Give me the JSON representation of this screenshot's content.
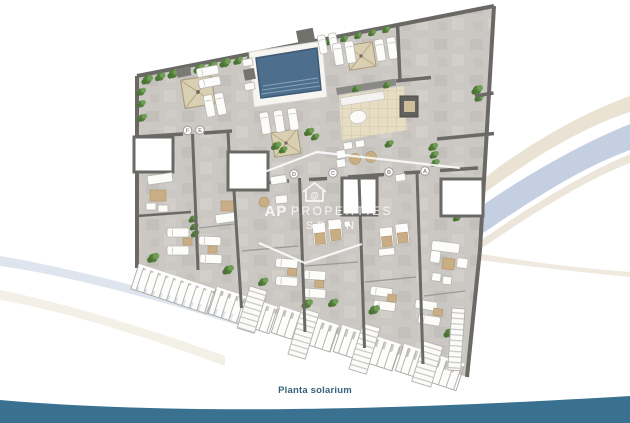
{
  "page": {
    "background_color": "#ffffff",
    "type": "floor-plan-render"
  },
  "floorplan": {
    "caption": "Planta solarium",
    "units": [
      {
        "label": "F"
      },
      {
        "label": "E"
      },
      {
        "label": "D"
      },
      {
        "label": "C"
      },
      {
        "label": "B"
      },
      {
        "label": "A"
      }
    ],
    "features": [
      "swimming-pool",
      "pool-deck",
      "parasols",
      "sun-loungers",
      "hedge-planters",
      "outdoor-kitchen-bar",
      "dining-set",
      "lounge-sofa-set",
      "stair-skylights",
      "private-terraces",
      "railings",
      "staircases"
    ]
  },
  "watermark": {
    "brand": "AP",
    "line1": "PROPERTIES",
    "line2": "SPAIN",
    "icon": "house-at-icon",
    "icon_glyph": "@"
  },
  "colors": {
    "floor": "#cbc8c4",
    "walls": "#6a6965",
    "pool_water": "#4e6e8d",
    "pool_steps": "#85a2ba",
    "deck_white": "#f6f5f2",
    "hedge_green": "#567f3e",
    "parasol_beige": "#d9cfb2",
    "wood_tan": "#c9ae85",
    "tile_beige": "#e7ddc4",
    "caption_text": "#34617c",
    "swoosh_blue": "#c4cfe2",
    "swoosh_beige": "#eae2d3",
    "bottom_wave": "#3b7190"
  }
}
